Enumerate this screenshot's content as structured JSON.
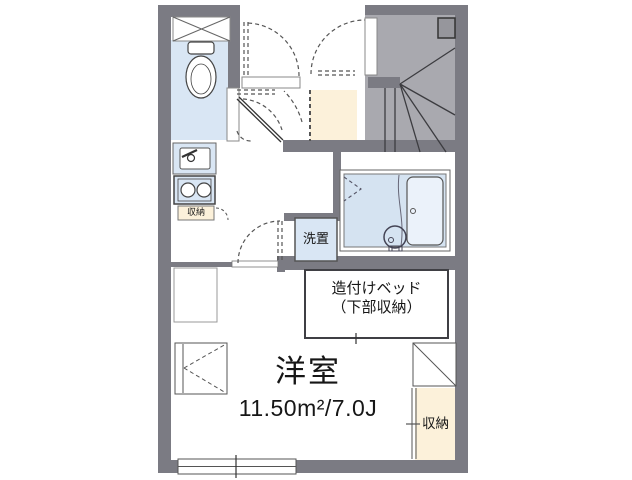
{
  "floorplan": {
    "labels": {
      "room_name": "洋室",
      "room_size": "11.50m²/7.0J",
      "bed_line1": "造付けベッド",
      "bed_line2": "（下部収納）",
      "washer": "洗置",
      "kitchen_storage": "収納",
      "closet": "収納"
    },
    "colors": {
      "wall": "#7b7b83",
      "stairs": "#a9a9af",
      "water": "#d9e6f4",
      "bath": "#d5e3f1",
      "tub": "#ebf2fa",
      "cream": "#fcf1da",
      "line": "#3c3c40",
      "text": "#161616"
    }
  }
}
